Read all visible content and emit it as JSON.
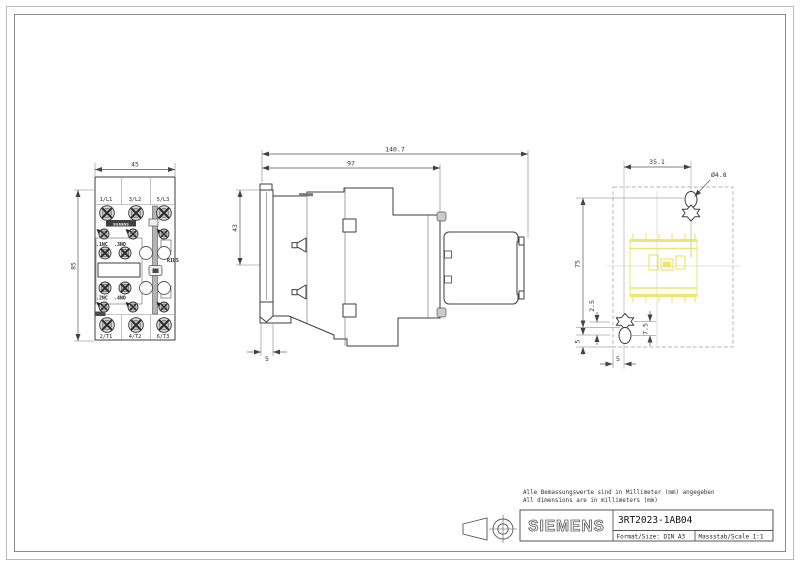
{
  "page": {
    "notes": [
      "Alle Bemassungswerte sind in Millimeter (mm) angegeben",
      "All dimensions are in millimeters (mm)"
    ],
    "title_block": {
      "brand": "SIEMENS",
      "part_number": "3RT2023-1AB04",
      "format_label": "Format/Size: DIN A3",
      "scale_label": "Massstab/Scale 1:1"
    }
  },
  "front_view": {
    "dims": {
      "width": "45",
      "height": "85"
    },
    "terminals_top": [
      "1/L1",
      "3/L2",
      "5/L3"
    ],
    "terminals_bottom": [
      "2/T1",
      "4/T2",
      "6/T3"
    ],
    "aux_top": [
      ".1NC",
      ".3NO"
    ],
    "aux_bottom": [
      ".2NC",
      ".4NO"
    ],
    "brand_plate": "SIEMENS",
    "series_text": "RIUS"
  },
  "side_view": {
    "dims": {
      "total_depth": "140.7",
      "body_depth": "97",
      "upper_height": "43",
      "rail_width": "5"
    }
  },
  "rear_view": {
    "dims": {
      "hole_spacing": "35.1",
      "hole_diameter": "Ø4.8",
      "mount_height": "75",
      "offset_small": "2.5",
      "slot_offset": "7.5",
      "edge_offset": "5",
      "base_offset": "5"
    }
  },
  "colors": {
    "highlight_yellow": "#ece254",
    "line": "#3d3d3d",
    "dimension": "#555555"
  }
}
